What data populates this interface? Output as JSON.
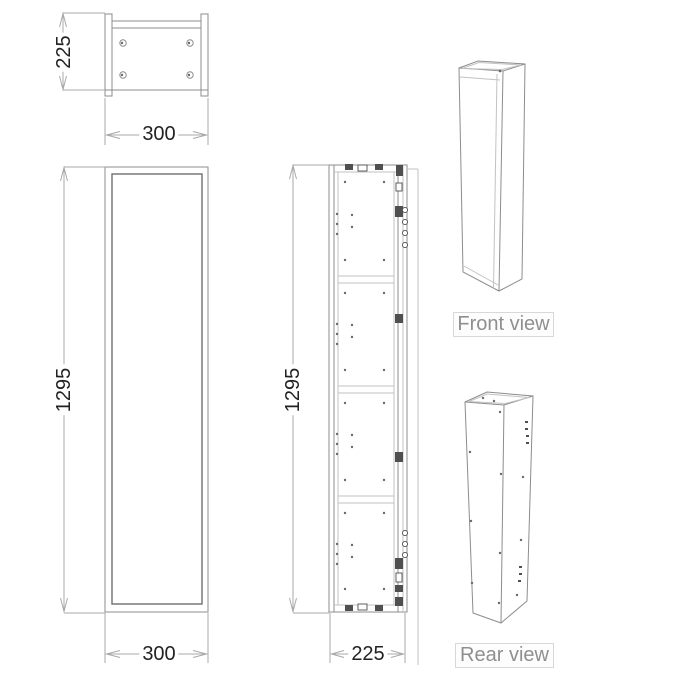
{
  "drawing": {
    "views": {
      "plan": {
        "depth_mm": "225",
        "width_mm": "300"
      },
      "front": {
        "height_mm": "1295",
        "width_mm": "300"
      },
      "section": {
        "height_mm": "1295",
        "depth_mm": "225"
      },
      "iso_front": {
        "caption": "Front view"
      },
      "iso_rear": {
        "caption": "Rear view"
      }
    }
  },
  "colors": {
    "background": "#ffffff",
    "line": "#8d8d8d",
    "line_dark": "#6e6e6e",
    "line_light": "#c2c2c2",
    "dim_line": "#a9a9a9",
    "text": "#222222",
    "caption_text": "#8f8f8f",
    "caption_border": "#d8d8d8",
    "hardware": "#4f4f4f"
  }
}
